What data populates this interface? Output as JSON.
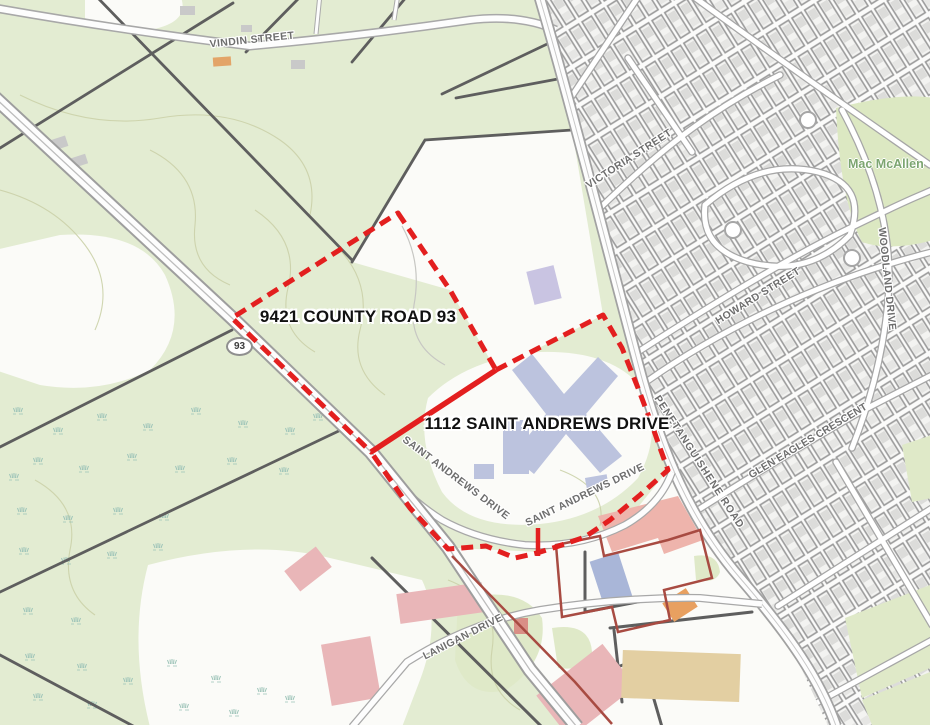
{
  "map": {
    "annotations": {
      "parcel_1_label": "9421 COUNTY ROAD 93",
      "parcel_2_label": "1112 SAINT ANDREWS DRIVE"
    },
    "street_labels": {
      "vindin": "VINDIN STREET",
      "victoria": "VICTORIA STREET",
      "howard": "HOWARD STREET",
      "woodland": "WOODLAND DRIVE",
      "glen_eagles": "GLEN EAGLES CRESCENT",
      "penetanguishene": "PENETANGUISHENE ROAD",
      "saint_andrews_west": "SAINT ANDREWS DRIVE",
      "saint_andrews_east": "SAINT ANDREWS DRIVE",
      "lanigan": "LANIGAN DRIVE"
    },
    "route_shield": {
      "number": "93"
    },
    "park_label": "Mac McAllen",
    "colors": {
      "highlight_boundary_red": "#e31f1f",
      "secondary_parcel_red": "#a84b42",
      "rural_land_green": "#e3ecd2",
      "lot_line_gray": "#9a9a9a",
      "parcel_line_dark_gray": "#5e5e5e",
      "school_building_lavender": "#bcc3de",
      "commercial_pink": "#e9b6b8",
      "commercial_salmon": "#eeb4ac",
      "commercial_tan": "#e3cfa2",
      "commercial_orange": "#e8a060",
      "marsh_teal": "#9cc3b8",
      "street_label_text": "#6e6e6e",
      "park_label_text": "#7ca570"
    }
  }
}
